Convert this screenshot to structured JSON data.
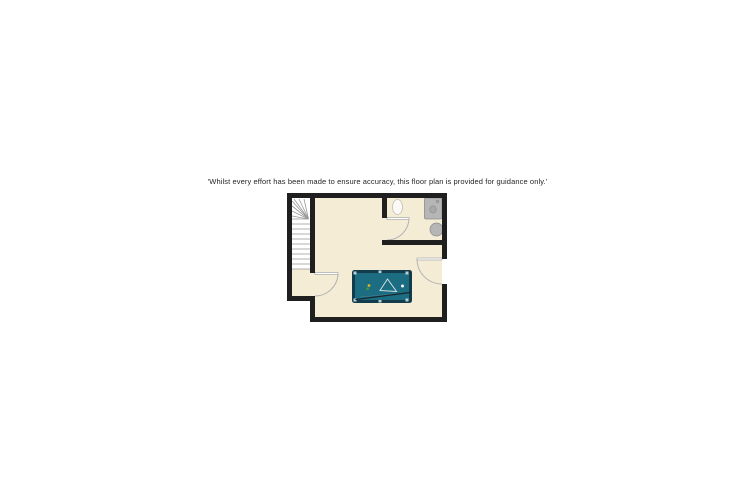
{
  "disclaimer": {
    "text": "'Whilst every effort has been made to ensure accuracy, this floor plan is provided for guidance only.'"
  },
  "floor_plan": {
    "icons": [
      "staircase-icon",
      "toilet-icon",
      "vanity-basin-icon",
      "wash-basin-icon",
      "door-arc-icon",
      "pool-table-icon",
      "triangle-rack-icon",
      "cue-stick-icon"
    ],
    "door_count": 3,
    "colors": {
      "text": "#262626",
      "wall": "#1f1f1f",
      "floor": "#f5ecd6",
      "stair_fill": "#ffffff",
      "stair_line": "#999999",
      "door_line": "#b3b3b3",
      "leaf_fill": "#ffffff",
      "leaf_line": "#a8a8a8",
      "fixture_fill": "#b6b6b6",
      "fixture_line": "#8d8d8d",
      "toilet_fill": "#fbfaf6",
      "table_frame": "#123c4c",
      "table_felt": "#1c6c82",
      "pocket": "#b9cdd5",
      "triangle_line": "#dfe9ec",
      "cue_line": "#17262e",
      "ball_cue": "#f2f5f5",
      "ball_yellow": "#dcb32b",
      "ball_green": "#46953c"
    }
  }
}
